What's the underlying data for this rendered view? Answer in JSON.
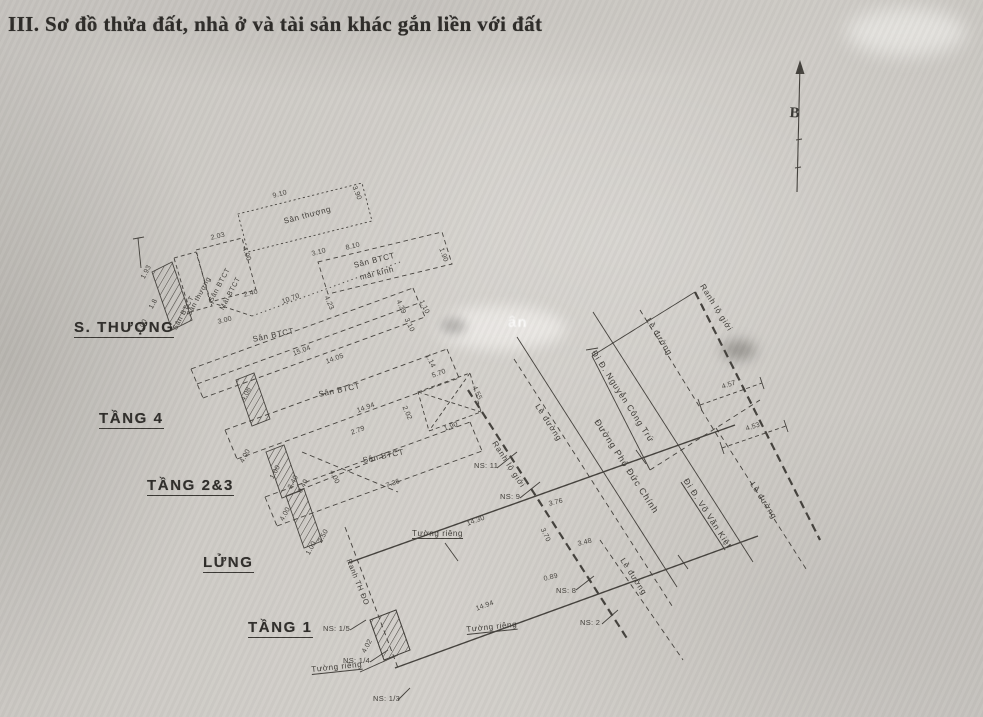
{
  "header": {
    "title": "III. Sơ đồ thửa đất, nhà ở và tài sản khác gắn liền với đất"
  },
  "compass": {
    "north_label": "B"
  },
  "colors": {
    "ink": "#44413c",
    "ink_dark": "#2f2d2a",
    "paper": "#cecbc6"
  },
  "floor_names": [
    {
      "t": "S. THƯỢNG",
      "x": 74,
      "y": 320
    },
    {
      "t": "TẦNG 4",
      "x": 99,
      "y": 411
    },
    {
      "t": "TẦNG 2&3",
      "x": 147,
      "y": 478
    },
    {
      "t": "LỬNG",
      "x": 203,
      "y": 555
    },
    {
      "t": "TẦNG 1",
      "x": 248,
      "y": 620
    }
  ],
  "area_labels": [
    {
      "t": "Sân thượng",
      "x": 283,
      "y": 218,
      "r": -15,
      "fs": 8
    },
    {
      "t": "Sân BTCT",
      "x": 353,
      "y": 262,
      "r": -14,
      "fs": 8
    },
    {
      "t": "mái kính",
      "x": 359,
      "y": 274,
      "r": -14,
      "fs": 8
    },
    {
      "t": "Sân BTCT",
      "x": 208,
      "y": 300,
      "r": -62,
      "fs": 7
    },
    {
      "t": "Mái BTCT",
      "x": 219,
      "y": 308,
      "r": -62,
      "fs": 7
    },
    {
      "t": "Sân thượng",
      "x": 186,
      "y": 314,
      "r": -62,
      "fs": 7
    },
    {
      "t": "Sân BTCT",
      "x": 172,
      "y": 328,
      "r": -62,
      "fs": 7
    },
    {
      "t": "Sân BTCT",
      "x": 252,
      "y": 336,
      "r": -12,
      "fs": 8
    },
    {
      "t": "Sân BTCT",
      "x": 318,
      "y": 391,
      "r": -12,
      "fs": 8
    },
    {
      "t": "Sân BTCT",
      "x": 362,
      "y": 457,
      "r": -12,
      "fs": 8
    },
    {
      "t": "Tường riêng",
      "x": 412,
      "y": 530,
      "r": 0,
      "fs": 8,
      "u": true
    },
    {
      "t": "Tường riêng",
      "x": 466,
      "y": 626,
      "r": -6,
      "fs": 8,
      "u": true
    },
    {
      "t": "Tường riêng",
      "x": 311,
      "y": 666,
      "r": -6,
      "fs": 8,
      "u": true
    },
    {
      "t": "Ranh TH ĐO",
      "x": 352,
      "y": 558,
      "r": 68,
      "fs": 7.5
    }
  ],
  "road_labels": [
    {
      "t": "Đường Phó Đức Chính",
      "x": 600,
      "y": 418,
      "r": 57,
      "fs": 9
    },
    {
      "t": "Đi Đ. Nguyễn Công Trứ",
      "x": 597,
      "y": 349,
      "r": 57,
      "fs": 8.5
    },
    {
      "t": "Đi Đ. Võ Văn Kiệt",
      "x": 689,
      "y": 477,
      "r": 57,
      "fs": 8.5,
      "u": true
    },
    {
      "t": "Ranh lộ giới",
      "x": 497,
      "y": 440,
      "r": 57,
      "fs": 8
    },
    {
      "t": "Ranh lộ giới",
      "x": 705,
      "y": 283,
      "r": 58,
      "fs": 8
    },
    {
      "t": "Lề đường",
      "x": 540,
      "y": 403,
      "r": 57,
      "fs": 8
    },
    {
      "t": "Lề đường",
      "x": 651,
      "y": 317,
      "r": 58,
      "fs": 8
    },
    {
      "t": "Lề đường",
      "x": 625,
      "y": 557,
      "r": 57,
      "fs": 8
    },
    {
      "t": "Lề đường",
      "x": 755,
      "y": 481,
      "r": 57,
      "fs": 8
    }
  ],
  "dimensions": [
    {
      "t": "9.10",
      "x": 272,
      "y": 193,
      "r": -15
    },
    {
      "t": "3.90",
      "x": 357,
      "y": 185,
      "r": 68
    },
    {
      "t": "3.10",
      "x": 311,
      "y": 251,
      "r": -15
    },
    {
      "t": "8.10",
      "x": 345,
      "y": 245,
      "r": -14
    },
    {
      "t": "1.90",
      "x": 444,
      "y": 247,
      "r": 70
    },
    {
      "t": "4.23",
      "x": 329,
      "y": 295,
      "r": 66
    },
    {
      "t": "4.39",
      "x": 401,
      "y": 299,
      "r": 66
    },
    {
      "t": "2.03",
      "x": 210,
      "y": 235,
      "r": -14
    },
    {
      "t": "4.00",
      "x": 247,
      "y": 246,
      "r": 70
    },
    {
      "t": "2.40",
      "x": 243,
      "y": 292,
      "r": -14
    },
    {
      "t": "3.00",
      "x": 217,
      "y": 319,
      "r": -14
    },
    {
      "t": "10.70",
      "x": 281,
      "y": 299,
      "r": -20
    },
    {
      "t": "1.93",
      "x": 140,
      "y": 277,
      "r": -62
    },
    {
      "t": "1.8",
      "x": 148,
      "y": 307,
      "r": -62
    },
    {
      "t": "2.00",
      "x": 136,
      "y": 331,
      "r": -62
    },
    {
      "t": "15.04",
      "x": 292,
      "y": 351,
      "r": -20
    },
    {
      "t": "14.05",
      "x": 325,
      "y": 359,
      "r": -20
    },
    {
      "t": "4.08",
      "x": 240,
      "y": 399,
      "r": -62
    },
    {
      "t": "1.10",
      "x": 424,
      "y": 299,
      "r": 64
    },
    {
      "t": "3.10",
      "x": 409,
      "y": 317,
      "r": 64
    },
    {
      "t": "1.14",
      "x": 430,
      "y": 353,
      "r": 64
    },
    {
      "t": "14.94",
      "x": 356,
      "y": 408,
      "r": -20
    },
    {
      "t": "2.79",
      "x": 350,
      "y": 430,
      "r": -20
    },
    {
      "t": "4.00",
      "x": 239,
      "y": 461,
      "r": -62
    },
    {
      "t": "1.00",
      "x": 269,
      "y": 477,
      "r": -62
    },
    {
      "t": "3.40",
      "x": 287,
      "y": 487,
      "r": -62
    },
    {
      "t": "5.70",
      "x": 431,
      "y": 373,
      "r": -20
    },
    {
      "t": "2.02",
      "x": 407,
      "y": 405,
      "r": 66
    },
    {
      "t": "1.90",
      "x": 443,
      "y": 426,
      "r": -20
    },
    {
      "t": "4.55",
      "x": 477,
      "y": 385,
      "r": 66
    },
    {
      "t": "7.36",
      "x": 385,
      "y": 483,
      "r": -20
    },
    {
      "t": "4.00",
      "x": 334,
      "y": 469,
      "r": 64
    },
    {
      "t": "4.00",
      "x": 279,
      "y": 519,
      "r": -62
    },
    {
      "t": "0.40",
      "x": 297,
      "y": 491,
      "r": -62
    },
    {
      "t": "2.50",
      "x": 317,
      "y": 541,
      "r": -62
    },
    {
      "t": "1.00",
      "x": 305,
      "y": 553,
      "r": -62
    },
    {
      "t": "14.30",
      "x": 466,
      "y": 521,
      "r": -20
    },
    {
      "t": "14.94",
      "x": 475,
      "y": 606,
      "r": -20
    },
    {
      "t": "4.02",
      "x": 361,
      "y": 651,
      "r": -62
    },
    {
      "t": "3.76",
      "x": 548,
      "y": 501,
      "r": -14
    },
    {
      "t": "3.70",
      "x": 545,
      "y": 527,
      "r": 64
    },
    {
      "t": "3.48",
      "x": 577,
      "y": 541,
      "r": -14
    },
    {
      "t": "0.89",
      "x": 543,
      "y": 576,
      "r": -14
    },
    {
      "t": "4.57",
      "x": 721,
      "y": 384,
      "r": -18
    },
    {
      "t": "4.53",
      "x": 745,
      "y": 426,
      "r": -18
    }
  ],
  "neighbors": [
    {
      "t": "NS: 11",
      "x": 474,
      "y": 462
    },
    {
      "t": "NS: 9",
      "x": 500,
      "y": 493
    },
    {
      "t": "NS: 8",
      "x": 556,
      "y": 587
    },
    {
      "t": "NS: 2",
      "x": 580,
      "y": 619
    },
    {
      "t": "NS: 1/5",
      "x": 323,
      "y": 625
    },
    {
      "t": "NS: 1/4",
      "x": 343,
      "y": 657
    },
    {
      "t": "NS: 1/3",
      "x": 373,
      "y": 695
    }
  ],
  "watermark": {
    "t": "ân"
  }
}
